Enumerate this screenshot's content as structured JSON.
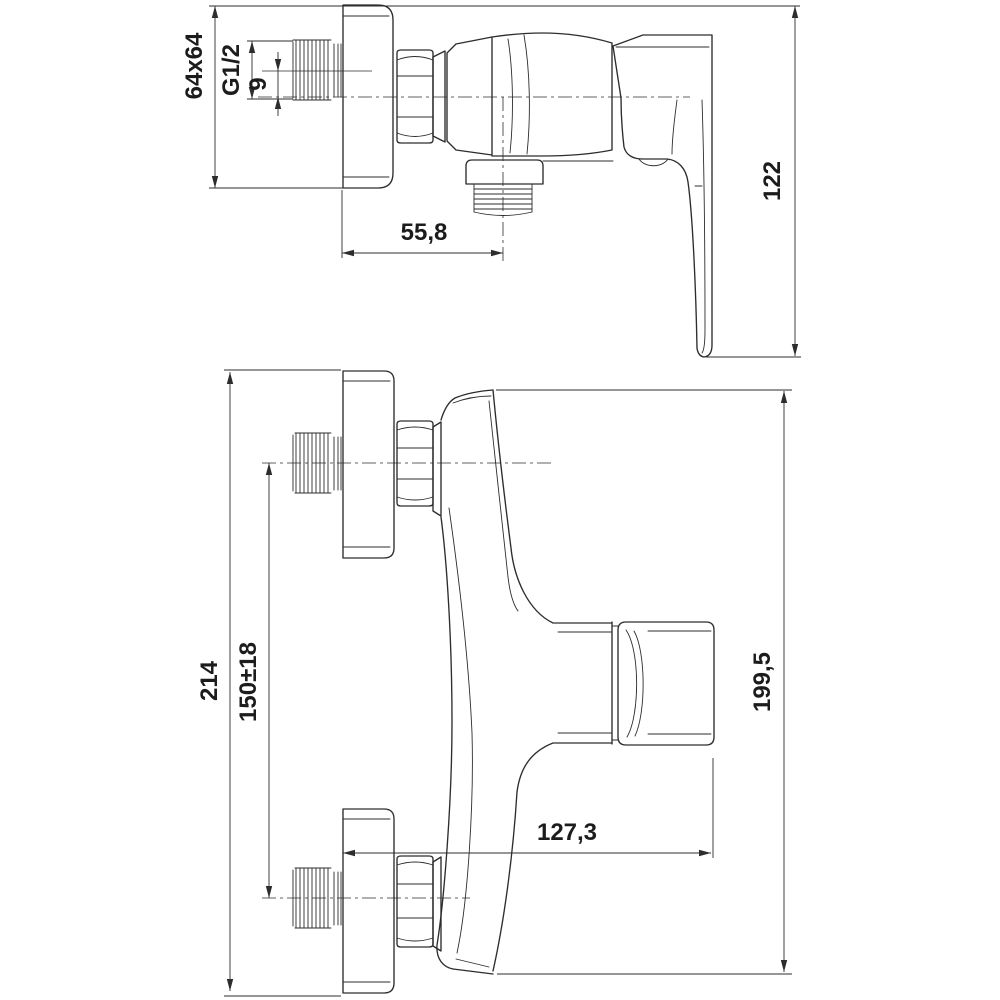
{
  "drawing": {
    "background": "#ffffff",
    "line_color": "#2d2d2d",
    "text_color": "#1c1c1c",
    "views": {
      "side": {
        "title": "side-view-of-shower-mixer",
        "dims": {
          "flange_square": "64x64",
          "inlet_thread": "G1/2",
          "axis_offset": "9",
          "outlet_offset": "55,8",
          "height": "122"
        }
      },
      "front": {
        "title": "front-view-of-shower-mixer",
        "dims": {
          "overall_plate_span": "214",
          "connection_spacing": "150±18",
          "depth": "127,3",
          "height": "199,5"
        }
      }
    }
  }
}
